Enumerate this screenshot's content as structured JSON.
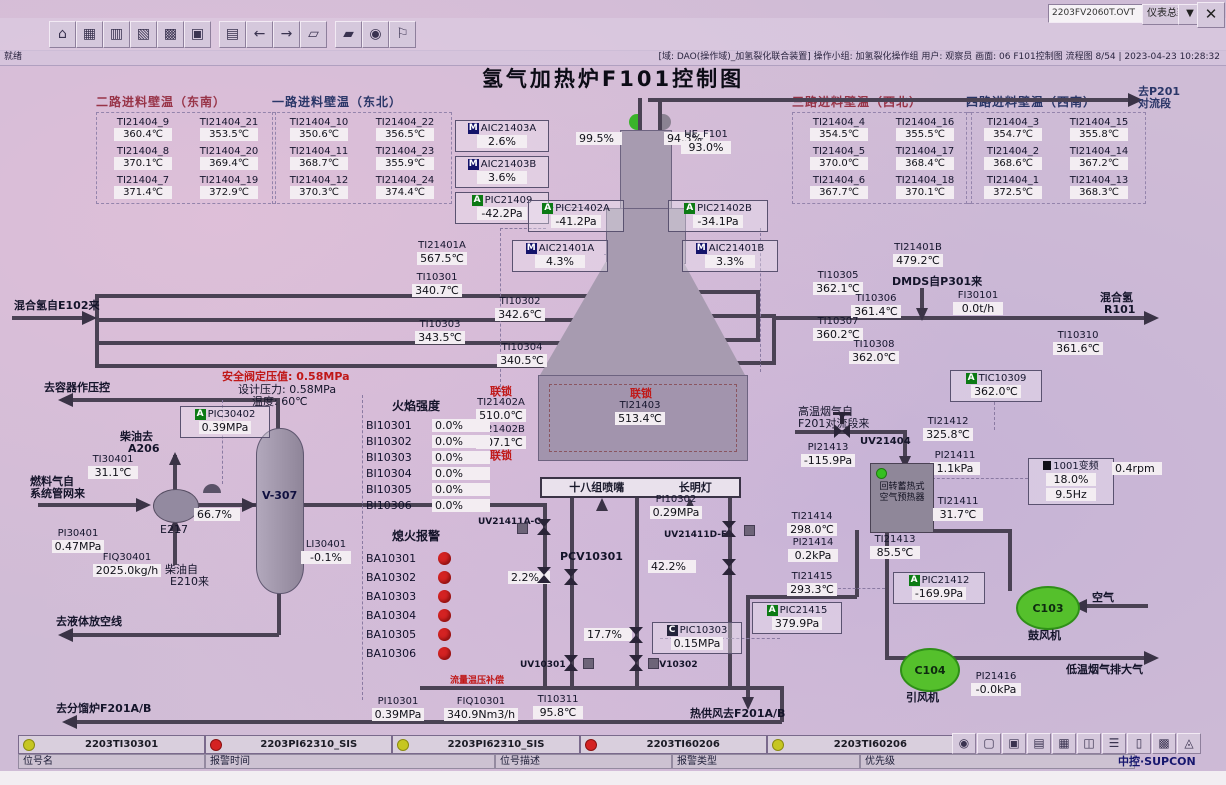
{
  "header": {
    "screen_file": "2203FV2060T.OVT",
    "view_selector": "仪表总貌",
    "close": "✕",
    "status_left": "就绪",
    "status_right": "[域: DAO(操作域)_加氢裂化联合装置] 操作小组: 加氢裂化操作组 用户: 观察员 画面: 06 F101控制图 流程图 8/54 | 2023-04-23 10:28:32",
    "toolbar_icons": [
      {
        "g": "⌂",
        "name": "home-icon"
      },
      {
        "g": "▦",
        "name": "overview-icon"
      },
      {
        "g": "▥",
        "name": "group-display-icon"
      },
      {
        "g": "▧",
        "name": "trend-icon"
      },
      {
        "g": "▩",
        "name": "schedule-icon"
      },
      {
        "g": "▣",
        "name": "batch-icon"
      },
      {
        "g": "▤",
        "name": "report-icon"
      },
      {
        "g": "←",
        "name": "back-icon"
      },
      {
        "g": "→",
        "name": "forward-icon"
      },
      {
        "g": "▱",
        "name": "prev-page-icon"
      },
      {
        "g": "▰",
        "name": "next-page-icon"
      },
      {
        "g": "◉",
        "name": "find-icon"
      },
      {
        "g": "⚐",
        "name": "user-icon"
      }
    ],
    "bottom_icons": [
      {
        "g": "◉",
        "name": "user-switch-icon"
      },
      {
        "g": "▢",
        "name": "lock-icon"
      },
      {
        "g": "▣",
        "name": "screen-icon"
      },
      {
        "g": "▤",
        "name": "alarm-pc-icon"
      },
      {
        "g": "▦",
        "name": "spreadsheet-icon"
      },
      {
        "g": "◫",
        "name": "alarm-doc-icon"
      },
      {
        "g": "☰",
        "name": "list-icon"
      },
      {
        "g": "▯",
        "name": "document-icon"
      },
      {
        "g": "▩",
        "name": "grid-icon"
      },
      {
        "g": "◬",
        "name": "horn-icon"
      }
    ]
  },
  "title": "氢气加热炉F101控制图",
  "wall_tables": [
    {
      "header": "二路进料壁温（东南）",
      "cells": [
        {
          "tag": "TI21404_9",
          "val": "360.4℃"
        },
        {
          "tag": "TI21404_21",
          "val": "353.5℃"
        },
        {
          "tag": "TI21404_8",
          "val": "370.1℃"
        },
        {
          "tag": "TI21404_20",
          "val": "369.4℃"
        },
        {
          "tag": "TI21404_7",
          "val": "371.4℃"
        },
        {
          "tag": "TI21404_19",
          "val": "372.9℃"
        }
      ]
    },
    {
      "header": "一路进料壁温（东北）",
      "cells": [
        {
          "tag": "TI21404_10",
          "val": "350.6℃"
        },
        {
          "tag": "TI21404_22",
          "val": "356.5℃"
        },
        {
          "tag": "TI21404_11",
          "val": "368.7℃"
        },
        {
          "tag": "TI21404_23",
          "val": "355.9℃"
        },
        {
          "tag": "TI21404_12",
          "val": "370.3℃"
        },
        {
          "tag": "TI21404_24",
          "val": "374.4℃"
        }
      ]
    },
    {
      "header": "三路进料壁温（西北）",
      "cells": [
        {
          "tag": "TI21404_4",
          "val": "354.5℃"
        },
        {
          "tag": "TI21404_16",
          "val": "355.5℃"
        },
        {
          "tag": "TI21404_5",
          "val": "370.0℃"
        },
        {
          "tag": "TI21404_17",
          "val": "368.4℃"
        },
        {
          "tag": "TI21404_6",
          "val": "367.7℃"
        },
        {
          "tag": "TI21404_18",
          "val": "370.1℃"
        }
      ]
    },
    {
      "header": "四路进料壁温（西南）",
      "cells": [
        {
          "tag": "TI21404_3",
          "val": "354.7℃"
        },
        {
          "tag": "TI21404_15",
          "val": "355.8℃"
        },
        {
          "tag": "TI21404_2",
          "val": "368.6℃"
        },
        {
          "tag": "TI21404_14",
          "val": "367.2℃"
        },
        {
          "tag": "TI21404_1",
          "val": "372.5℃"
        },
        {
          "tag": "TI21404_13",
          "val": "368.3℃"
        }
      ]
    }
  ],
  "inst": {
    "aic21403a": {
      "tag": "AIC21403A",
      "val": "2.6%",
      "badge": "M"
    },
    "aic21403b": {
      "tag": "AIC21403B",
      "val": "3.6%",
      "badge": "M"
    },
    "pic21409": {
      "tag": "PIC21409",
      "val": "-42.2Pa",
      "badge": "A"
    },
    "pic21402a": {
      "tag": "PIC21402A",
      "val": "-41.2Pa",
      "badge": "A"
    },
    "pic21402b": {
      "tag": "PIC21402B",
      "val": "-34.1Pa",
      "badge": "A"
    },
    "aic21401a": {
      "tag": "AIC21401A",
      "val": "4.3%",
      "badge": "M"
    },
    "aic21401b": {
      "tag": "AIC21401B",
      "val": "3.3%",
      "badge": "M"
    },
    "ti21401a": {
      "tag": "TI21401A",
      "val": "567.5℃"
    },
    "ti21401b": {
      "tag": "TI21401B",
      "val": "479.2℃"
    },
    "ti10301": {
      "tag": "TI10301",
      "val": "340.7℃"
    },
    "ti10302": {
      "tag": "TI10302",
      "val": "342.6℃"
    },
    "ti10303": {
      "tag": "TI10303",
      "val": "343.5℃"
    },
    "ti10304": {
      "tag": "TI10304",
      "val": "340.5℃"
    },
    "ti10305": {
      "tag": "TI10305",
      "val": "362.1℃"
    },
    "ti10306": {
      "tag": "TI10306",
      "val": "361.4℃"
    },
    "ti10307": {
      "tag": "TI10307",
      "val": "360.2℃"
    },
    "ti10308": {
      "tag": "TI10308",
      "val": "362.0℃"
    },
    "fi30101": {
      "tag": "FI30101",
      "val": "0.0t/h"
    },
    "ti10310": {
      "tag": "TI10310",
      "val": "361.6℃"
    },
    "ti21402a": {
      "tag": "TI21402A",
      "val": "510.0℃"
    },
    "ti21402b": {
      "tag": "TI21402B",
      "val": "507.1℃"
    },
    "ti21403": {
      "tag": "TI21403",
      "val": "513.4℃"
    },
    "pic30402": {
      "tag": "PIC30402",
      "val": "0.39MPa",
      "badge": "A"
    },
    "ti30401": {
      "tag": "TI30401",
      "val": "31.1℃"
    },
    "pi30401": {
      "tag": "PI30401",
      "val": "0.47MPa"
    },
    "fiq30401": {
      "tag": "FIQ30401",
      "val": "2025.0kg/h"
    },
    "li30401": {
      "tag": "LI30401",
      "val": "-0.1%"
    },
    "pi10302": {
      "tag": "PI10302",
      "val": "0.29MPa"
    },
    "pic10303": {
      "tag": "PIC10303",
      "val": "0.15MPa",
      "badge": "C"
    },
    "pi10301": {
      "tag": "PI10301",
      "val": "0.39MPa"
    },
    "fiq10301": {
      "tag": "FIQ10301",
      "val": "340.9Nm3/h"
    },
    "ti10311": {
      "tag": "TI10311",
      "val": "95.8℃"
    },
    "tic10309": {
      "tag": "TIC10309",
      "val": "362.0℃",
      "badge": "A"
    },
    "ti21412": {
      "tag": "TI21412",
      "val": "325.8℃"
    },
    "pi21413": {
      "tag": "PI21413",
      "val": "-115.9Pa"
    },
    "pi21411": {
      "tag": "PI21411",
      "val": "1.1kPa"
    },
    "ti21411": {
      "tag": "TI21411",
      "val": "31.7℃"
    },
    "ti21414": {
      "tag": "TI21414",
      "val": "298.0℃"
    },
    "pi21414": {
      "tag": "PI21414",
      "val": "0.2kPa"
    },
    "ti21415": {
      "tag": "TI21415",
      "val": "293.3℃"
    },
    "ti21413": {
      "tag": "TI21413",
      "val": "85.5℃"
    },
    "pic21412": {
      "tag": "PIC21412",
      "val": "-169.9Pa",
      "badge": "A"
    },
    "pic21415": {
      "tag": "PIC21415",
      "val": "379.9Pa",
      "badge": "A"
    },
    "pi21416": {
      "tag": "PI21416",
      "val": "-0.0kPa"
    },
    "he_f101": {
      "tag": "HE_F101",
      "val": "93.0%"
    }
  },
  "valves": {
    "v995": "99.5%",
    "v943": "94.3%",
    "v667": "66.7%",
    "v022": "2.2%",
    "v422": "42.2%",
    "v177": "17.7%"
  },
  "uv": {
    "uv21404": "UV21404",
    "uv21411ac": "UV21411A-C",
    "uv21411df": "UV21411D-F",
    "pcv10301": "PCV10301",
    "uv10301": "UV10301",
    "uv10302": "UV10302"
  },
  "flame": {
    "header": "火焰强度",
    "items": [
      {
        "tag": "BI10301",
        "val": "0.0%"
      },
      {
        "tag": "BI10302",
        "val": "0.0%"
      },
      {
        "tag": "BI10303",
        "val": "0.0%"
      },
      {
        "tag": "BI10304",
        "val": "0.0%"
      },
      {
        "tag": "BI10305",
        "val": "0.0%"
      },
      {
        "tag": "BI10306",
        "val": "0.0%"
      }
    ]
  },
  "flameout": {
    "header": "熄火报警",
    "items": [
      {
        "tag": "BA10301"
      },
      {
        "tag": "BA10302"
      },
      {
        "tag": "BA10303"
      },
      {
        "tag": "BA10304"
      },
      {
        "tag": "BA10305"
      },
      {
        "tag": "BA10306"
      }
    ]
  },
  "vfd": {
    "label": "1001变频",
    "pct": "18.0%",
    "hz": "9.5Hz",
    "rpm": "0.4rpm"
  },
  "labels": {
    "to_p201_1": "去P201",
    "to_p201_2": "对流段",
    "mixed_h2_in": "混合氢自E102来",
    "dmds": "DMDS自P301来",
    "mixed_h2_out_1": "混合氢",
    "mixed_h2_out_2": "R101",
    "to_vessel_pc": "去容器作压控",
    "sv_set": "安全阀定压值: 0.58MPa",
    "design_p": "设计压力: 0.58MPa",
    "design_t": "温度: 60℃",
    "diesel_to_1": "柴油去",
    "diesel_to_2": "A206",
    "fuel_from_1": "燃料气自",
    "fuel_from_2": "系统管网来",
    "e217": "E217",
    "v307": "V-307",
    "diesel_from_1": "柴油自",
    "diesel_from_2": "E210来",
    "to_liquid_vent": "去液体放空线",
    "to_frac": "去分馏炉F201A/B",
    "interlock": "联锁",
    "burners": "十八组喷嘴",
    "pilot": "长明灯",
    "flow_comp": "流量温压补偿",
    "hot_air": "热供风去F201A/B",
    "hot_flue_1": "高温烟气自",
    "hot_flue_2": "F201对流段来",
    "preheater_1": "回转蓄热式",
    "preheater_2": "空气预热器",
    "c103": "C103",
    "c103_name": "鼓风机",
    "c104": "C104",
    "c104_name": "引风机",
    "air": "空气",
    "cold_flue": "低温烟气排大气"
  },
  "alarm_bar": {
    "items": [
      {
        "color": "y",
        "tag": "2203TI30301"
      },
      {
        "color": "r",
        "tag": "2203PI62310_SIS"
      },
      {
        "color": "y",
        "tag": "2203PI62310_SIS"
      },
      {
        "color": "r",
        "tag": "2203TI60206"
      },
      {
        "color": "y",
        "tag": "2203TI60206"
      }
    ],
    "headers": [
      "位号名",
      "报警时间",
      "位号描述",
      "报警类型",
      "优先级"
    ]
  },
  "logo": "中控·SUPCON",
  "colors": {
    "bg": "#cfbcd6",
    "red": "#c01818",
    "blue": "#2a3668",
    "green": "#35c020",
    "pipe": "#4a4254",
    "alarm_red": "#d42222",
    "alarm_yellow": "#c6c622"
  }
}
